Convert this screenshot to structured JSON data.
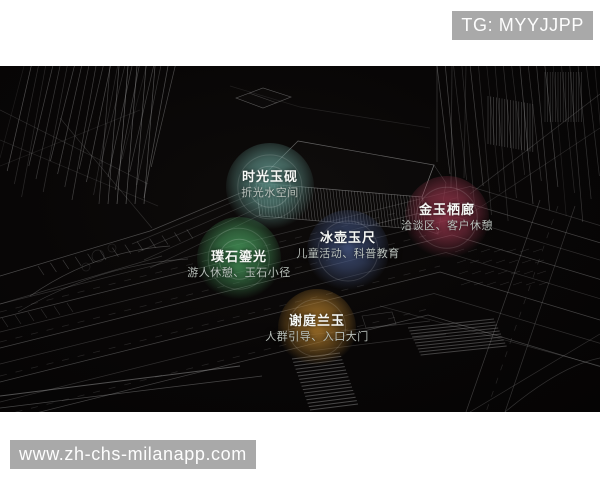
{
  "watermark_top": {
    "label": "TG: MYYJJPP"
  },
  "watermark_bottom": {
    "label": "www.zh-chs-milanapp.com"
  },
  "colors": {
    "watermark_bg": "#a9a9a9",
    "watermark_text": "#fdfdfd",
    "canvas_bg": "#080606",
    "wireframe_line": "#9a9a9a"
  },
  "bubbles": [
    {
      "title": "时光玉砚",
      "subtitle": "折光水空间",
      "color": "#63988f"
    },
    {
      "title": "金玉栖廊",
      "subtitle": "洽谈区、客户休憩",
      "color": "#96364c"
    },
    {
      "title": "冰壶玉尺",
      "subtitle": "儿童活动、科普教育",
      "color": "#3f4f78"
    },
    {
      "title": "璞石鎏光",
      "subtitle": "游人休憩、玉石小径",
      "color": "#46965a"
    },
    {
      "title": "谢庭兰玉",
      "subtitle": "人群引导、入口大门",
      "color": "#a8762a"
    }
  ]
}
